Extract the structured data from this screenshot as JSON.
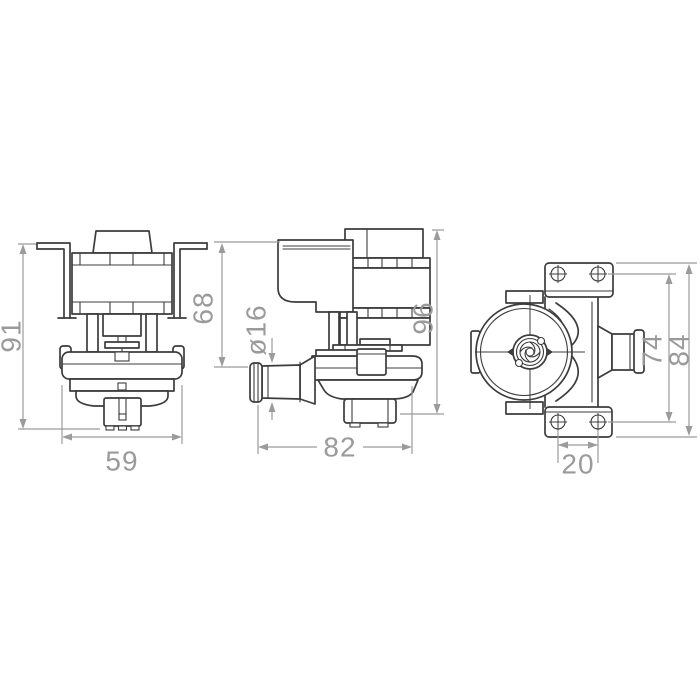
{
  "page": {
    "background": "#ffffff"
  },
  "drawing": {
    "title": "pump-three-view-technical-drawing",
    "line_color": "#3c3c3c",
    "dimension_color": "#9b9b9b",
    "views": [
      {
        "name": "front-view",
        "dimensions": [
          {
            "label": "91",
            "orientation": "vertical"
          },
          {
            "label": "59",
            "orientation": "horizontal"
          }
        ]
      },
      {
        "name": "side-view",
        "dimensions": [
          {
            "label": "68",
            "orientation": "vertical"
          },
          {
            "label": "ø16",
            "orientation": "vertical"
          },
          {
            "label": "96",
            "orientation": "vertical"
          },
          {
            "label": "82",
            "orientation": "horizontal"
          }
        ]
      },
      {
        "name": "rear-view",
        "dimensions": [
          {
            "label": "74",
            "orientation": "vertical"
          },
          {
            "label": "84",
            "orientation": "vertical"
          },
          {
            "label": "20",
            "orientation": "horizontal"
          }
        ]
      }
    ]
  }
}
